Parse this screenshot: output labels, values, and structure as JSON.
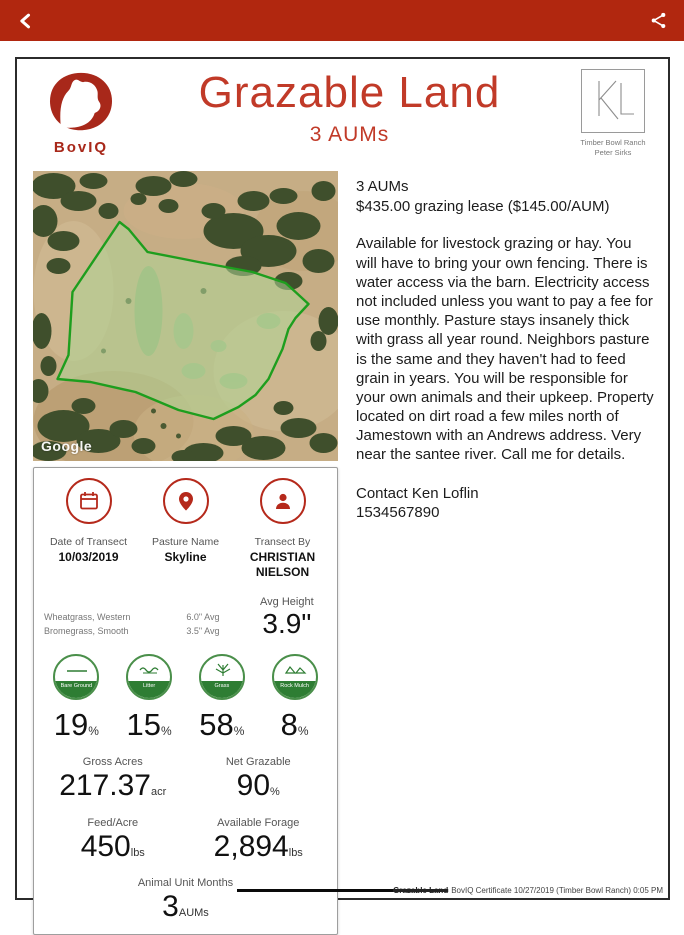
{
  "topbar": {
    "back_icon": "back-chevron",
    "share_icon": "android-share"
  },
  "header": {
    "app_name": "BovIQ",
    "title": "Grazable Land",
    "subtitle": "3 AUMs",
    "ranch_logo_text": "KL",
    "ranch_name": "Timber Bowl Ranch",
    "ranch_owner": "Peter Sirks"
  },
  "map": {
    "watermark": "Google"
  },
  "listing": {
    "aums_line": "3 AUMs",
    "price_line": "$435.00 grazing lease ($145.00/AUM)",
    "description": "Available for livestock grazing or hay. You will have to bring your own fencing. There is water access via the barn. Electricity access not included unless you want to pay a fee for use monthly. Pasture stays insanely thick with grass all year round. Neighbors pasture is the same and they haven't had to feed grain in years. You will be responsible for your own animals and their upkeep. Property located on dirt road a few miles north of Jamestown with an Andrews address. Very near the santee river. Call me for details.",
    "contact_name": "Contact Ken Loflin",
    "contact_phone": "1534567890"
  },
  "transect": {
    "date_label": "Date of Transect",
    "date_value": "10/03/2019",
    "pasture_label": "Pasture Name",
    "pasture_value": "Skyline",
    "by_label": "Transect By",
    "by_value": "CHRISTIAN NIELSON",
    "grasses": [
      "Wheatgrass, Western",
      "Bromegrass, Smooth"
    ],
    "grass_avgs": [
      "6.0\" Avg",
      "3.5\" Avg"
    ],
    "avg_height_label": "Avg Height",
    "avg_height_value": "3.9\""
  },
  "coverage": [
    {
      "label": "Bare Ground",
      "value": "19",
      "unit": "%"
    },
    {
      "label": "Litter",
      "value": "15",
      "unit": "%"
    },
    {
      "label": "Grass",
      "value": "58",
      "unit": "%"
    },
    {
      "label": "Rock Mulch",
      "value": "8",
      "unit": "%"
    }
  ],
  "stats": {
    "gross_acres_label": "Gross Acres",
    "gross_acres_value": "217.37",
    "gross_acres_unit": "acr",
    "net_grazable_label": "Net Grazable",
    "net_grazable_value": "90",
    "net_grazable_unit": "%",
    "feed_acre_label": "Feed/Acre",
    "feed_acre_value": "450",
    "feed_acre_unit": "lbs",
    "available_forage_label": "Available Forage",
    "available_forage_value": "2,894",
    "available_forage_unit": "lbs",
    "aum_label": "Animal Unit Months",
    "aum_value": "3",
    "aum_unit": "AUMs"
  },
  "footer": {
    "struck_text": "Grazable Land",
    "text": "BovIQ Certificate 10/27/2019 (Timber Bowl Ranch) 0:05 PM"
  },
  "colors": {
    "topbar_red": "#b1270f",
    "title_red": "#c13a28",
    "icon_red": "#b5291b",
    "coverage_green": "#2e7d33",
    "polygon_green": "#1e9e1e"
  }
}
